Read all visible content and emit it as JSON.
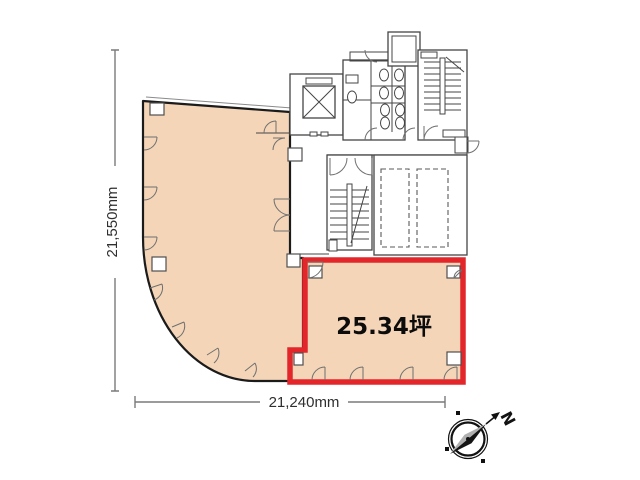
{
  "plan": {
    "area_label": "25.34坪",
    "width_dimension": "21,240mm",
    "height_dimension": "21,550mm",
    "compass_label": "N",
    "colors": {
      "room_fill": "#f4d5b8",
      "highlight": "#e3262a",
      "wall": "#1b1b1b",
      "detail": "#454545",
      "dimension": "#7a7a7a",
      "text": "#2f2f2f"
    }
  }
}
